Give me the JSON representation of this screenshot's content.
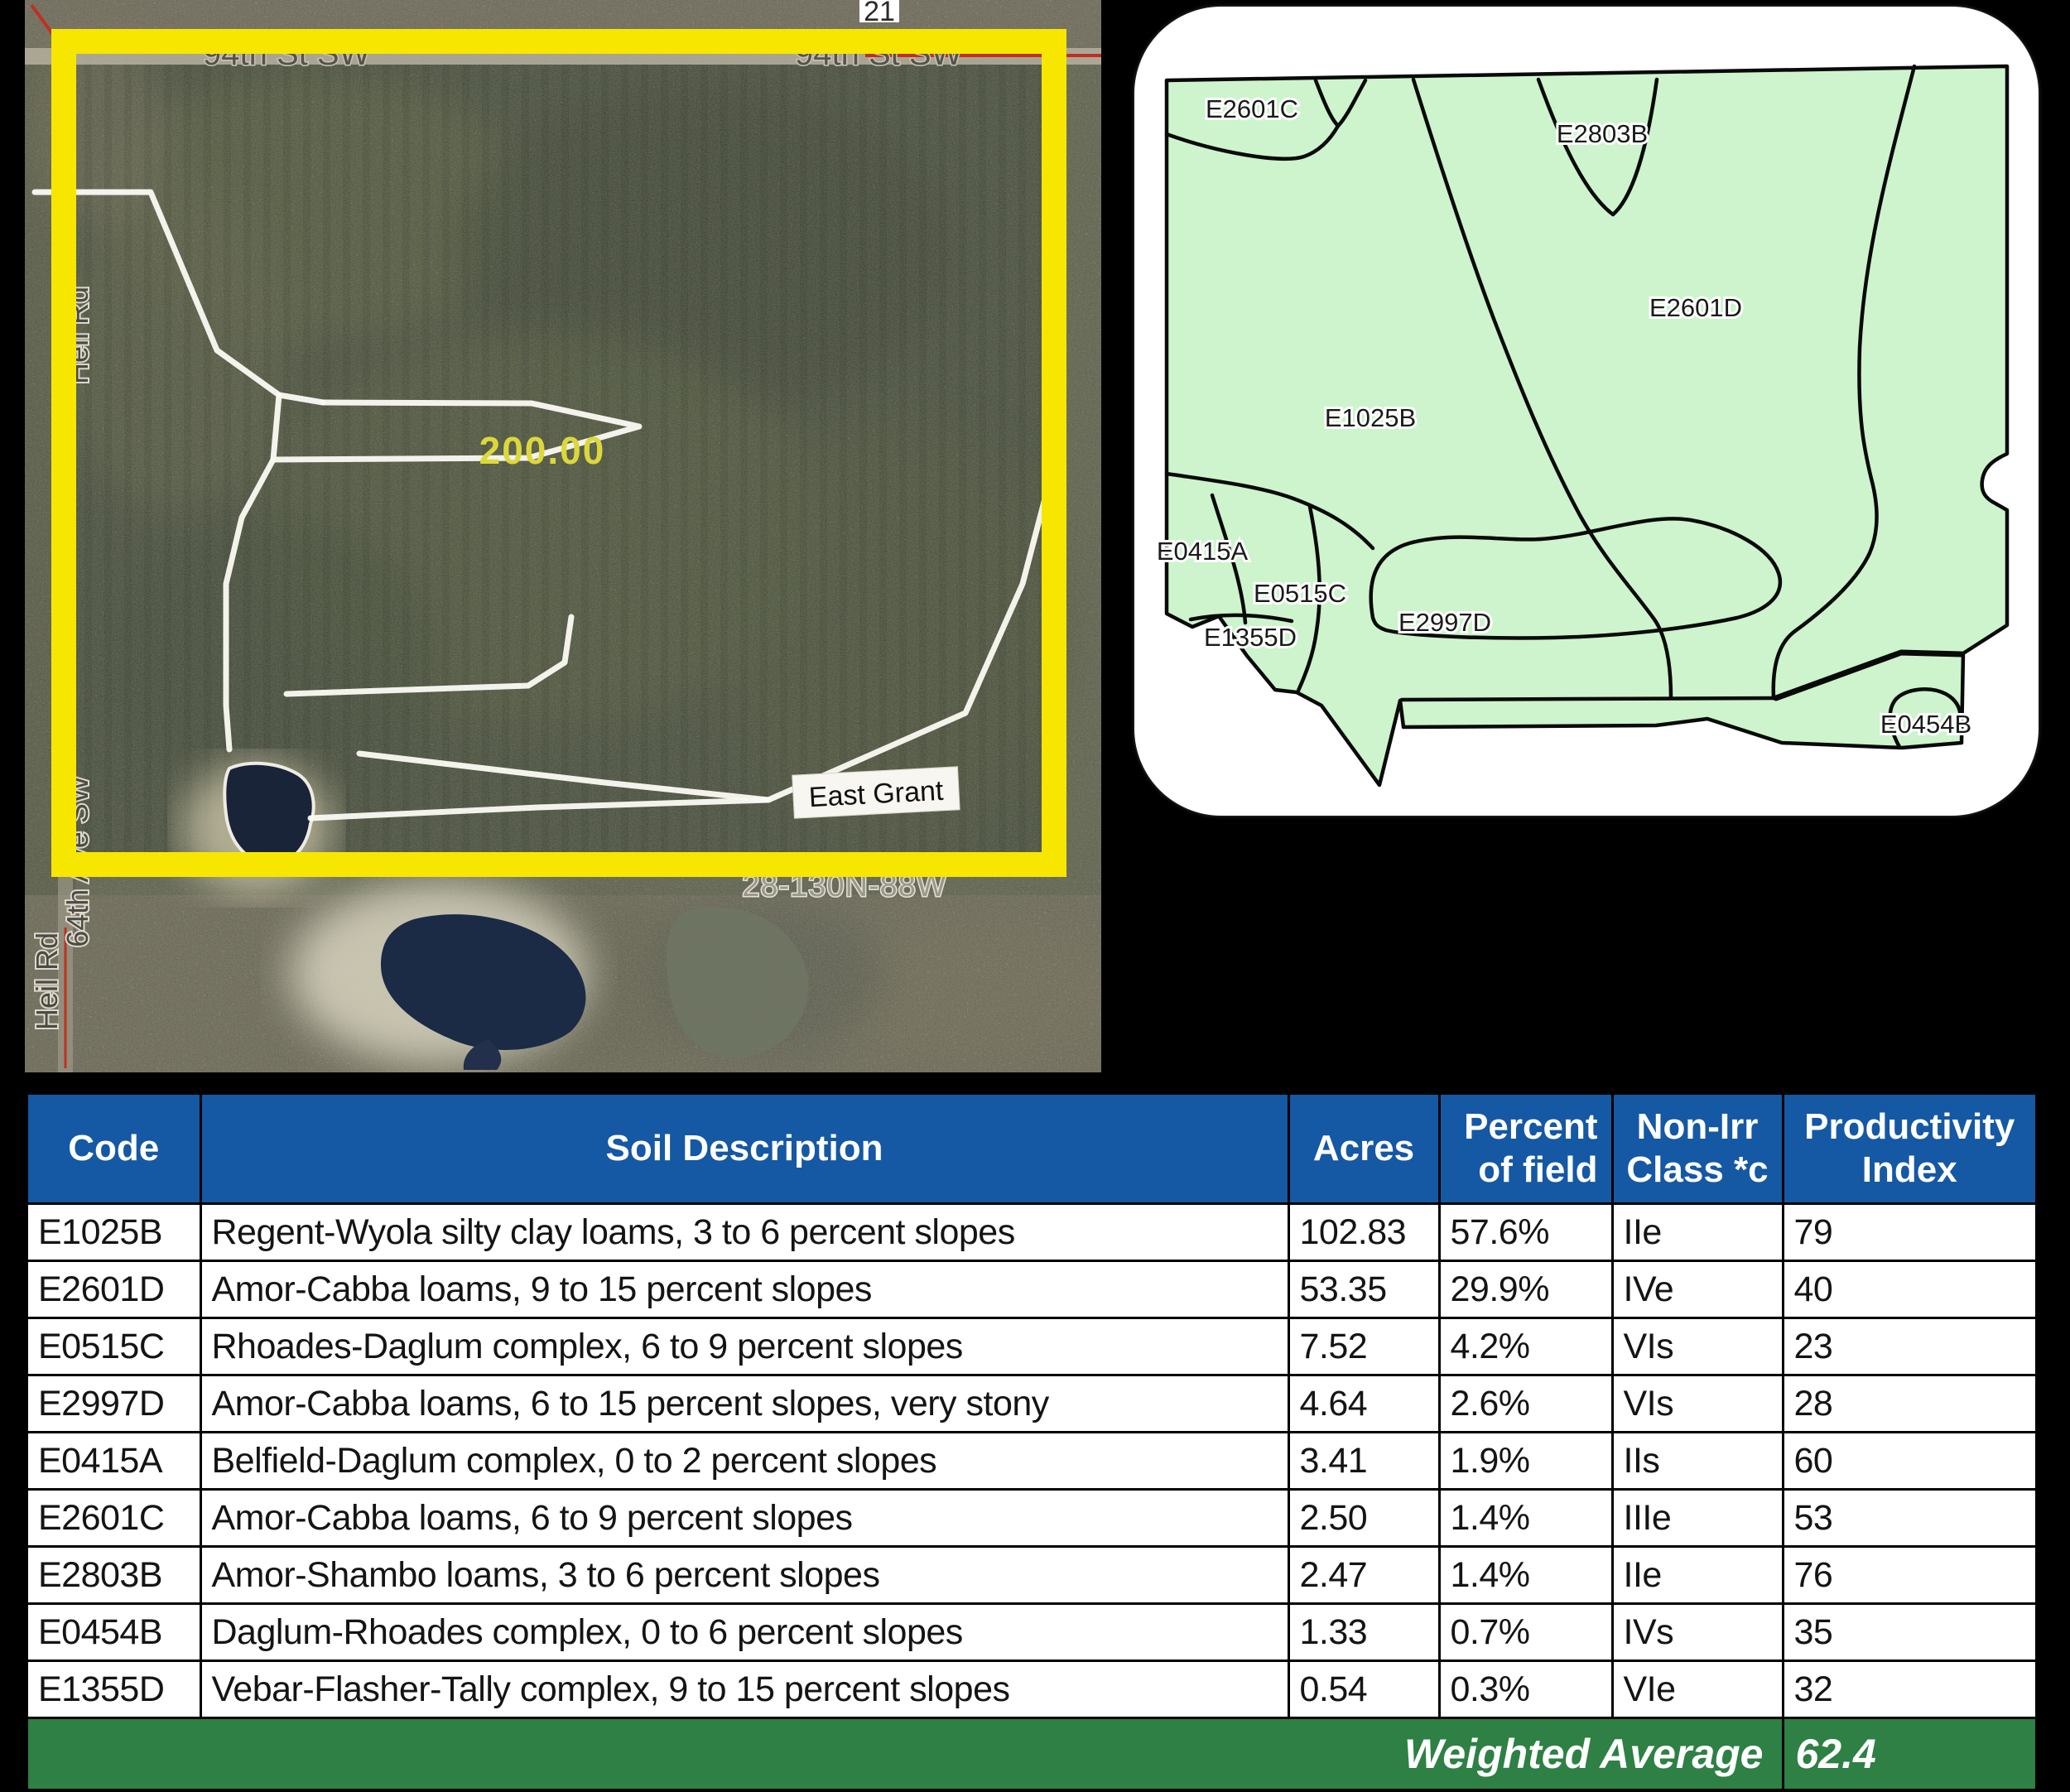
{
  "aerial": {
    "section_number": "21",
    "street_top_left": "94th St SW",
    "street_top_right": "94th St SW",
    "left_road_label_1": "Heil Rd",
    "left_road_label_2": "64th Ave SW",
    "left_road_label_3": "Heil Rd",
    "acreage_label": "200.00",
    "tract_label": "East Grant",
    "township_label": "28-130N-88W",
    "boundary_color": "#f7e600"
  },
  "soil_map": {
    "background_color": "#cdf4cc",
    "labels": [
      "E2601C",
      "E2803B",
      "E2601D",
      "E1025B",
      "E0415A",
      "E0515C",
      "E1355D",
      "E2997D",
      "E0454B"
    ]
  },
  "table": {
    "headers": [
      {
        "line1": "Code",
        "line2": ""
      },
      {
        "line1": "Soil Description",
        "line2": ""
      },
      {
        "line1": "Acres",
        "line2": ""
      },
      {
        "line1": "Percent",
        "line2": "of field"
      },
      {
        "line1": "Non-Irr",
        "line2": "Class *c"
      },
      {
        "line1": "Productivity",
        "line2": "Index"
      }
    ],
    "rows": [
      {
        "code": "E1025B",
        "description": "Regent-Wyola silty clay loams, 3 to 6 percent slopes",
        "acres": "102.83",
        "percent": "57.6%",
        "non_irr_class": "IIe",
        "productivity_index": "79",
        "row_class": "hl-bright"
      },
      {
        "code": "E2601D",
        "description": "Amor-Cabba loams, 9 to 15 percent slopes",
        "acres": "53.35",
        "percent": "29.9%",
        "non_irr_class": "IVe",
        "productivity_index": "40",
        "row_class": ""
      },
      {
        "code": "E0515C",
        "description": "Rhoades-Daglum complex, 6 to 9 percent slopes",
        "acres": "7.52",
        "percent": "4.2%",
        "non_irr_class": "VIs",
        "productivity_index": "23",
        "row_class": ""
      },
      {
        "code": "E2997D",
        "description": "Amor-Cabba loams, 6 to 15 percent slopes, very stony",
        "acres": "4.64",
        "percent": "2.6%",
        "non_irr_class": "VIs",
        "productivity_index": "28",
        "row_class": ""
      },
      {
        "code": "E0415A",
        "description": "Belfield-Daglum complex, 0 to 2 percent slopes",
        "acres": "3.41",
        "percent": "1.9%",
        "non_irr_class": "IIs",
        "productivity_index": "60",
        "row_class": "hl-pale"
      },
      {
        "code": "E2601C",
        "description": "Amor-Cabba loams, 6 to 9 percent slopes",
        "acres": "2.50",
        "percent": "1.4%",
        "non_irr_class": "IIIe",
        "productivity_index": "53",
        "row_class": "hl-pale"
      },
      {
        "code": "E2803B",
        "description": "Amor-Shambo loams, 3 to 6 percent slopes",
        "acres": "2.47",
        "percent": "1.4%",
        "non_irr_class": "IIe",
        "productivity_index": "76",
        "row_class": "hl-medium"
      },
      {
        "code": "E0454B",
        "description": "Daglum-Rhoades complex, 0 to 6 percent slopes",
        "acres": "1.33",
        "percent": "0.7%",
        "non_irr_class": "IVs",
        "productivity_index": "35",
        "row_class": ""
      },
      {
        "code": "E1355D",
        "description": "Vebar-Flasher-Tally complex, 9 to 15 percent slopes",
        "acres": "0.54",
        "percent": "0.3%",
        "non_irr_class": "VIe",
        "productivity_index": "32",
        "row_class": ""
      }
    ],
    "footer": {
      "label": "Weighted Average",
      "value": "62.4"
    },
    "colors": {
      "header_bg": "#1558a4",
      "highlight_bright": "#f6e33d",
      "highlight_pale": "#f8f1a0",
      "highlight_medium": "#f6e65e",
      "footer_bg": "#2e8044"
    }
  }
}
